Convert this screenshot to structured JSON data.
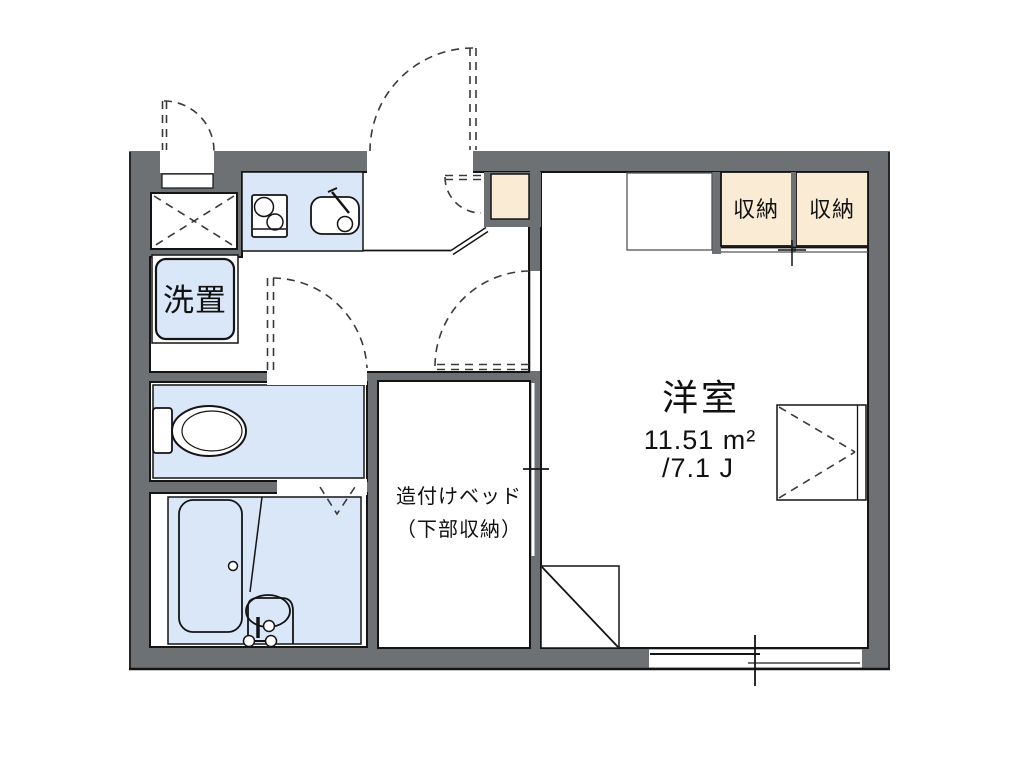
{
  "floor_plan": {
    "labels": {
      "laundry": "洗置",
      "storage_left": "収納",
      "storage_right": "収納",
      "room_name": "洋室",
      "room_area_m2": "11.51 m²",
      "room_area_jo": "/7.1 J",
      "bed_line1": "造付けベッド",
      "bed_line2": "（下部収納）"
    },
    "icons": {
      "stove": "stove-icon",
      "sink": "kitchen-sink-icon",
      "toilet": "toilet-icon",
      "bathtub": "bathtub-icon",
      "washbasin": "washbasin-icon"
    },
    "colors": {
      "wall_gray": "#6e7174",
      "water_area_blue": "#dae7f8",
      "storage_beige": "#faecd4",
      "line_black": "#141414",
      "background": "#ffffff"
    }
  }
}
